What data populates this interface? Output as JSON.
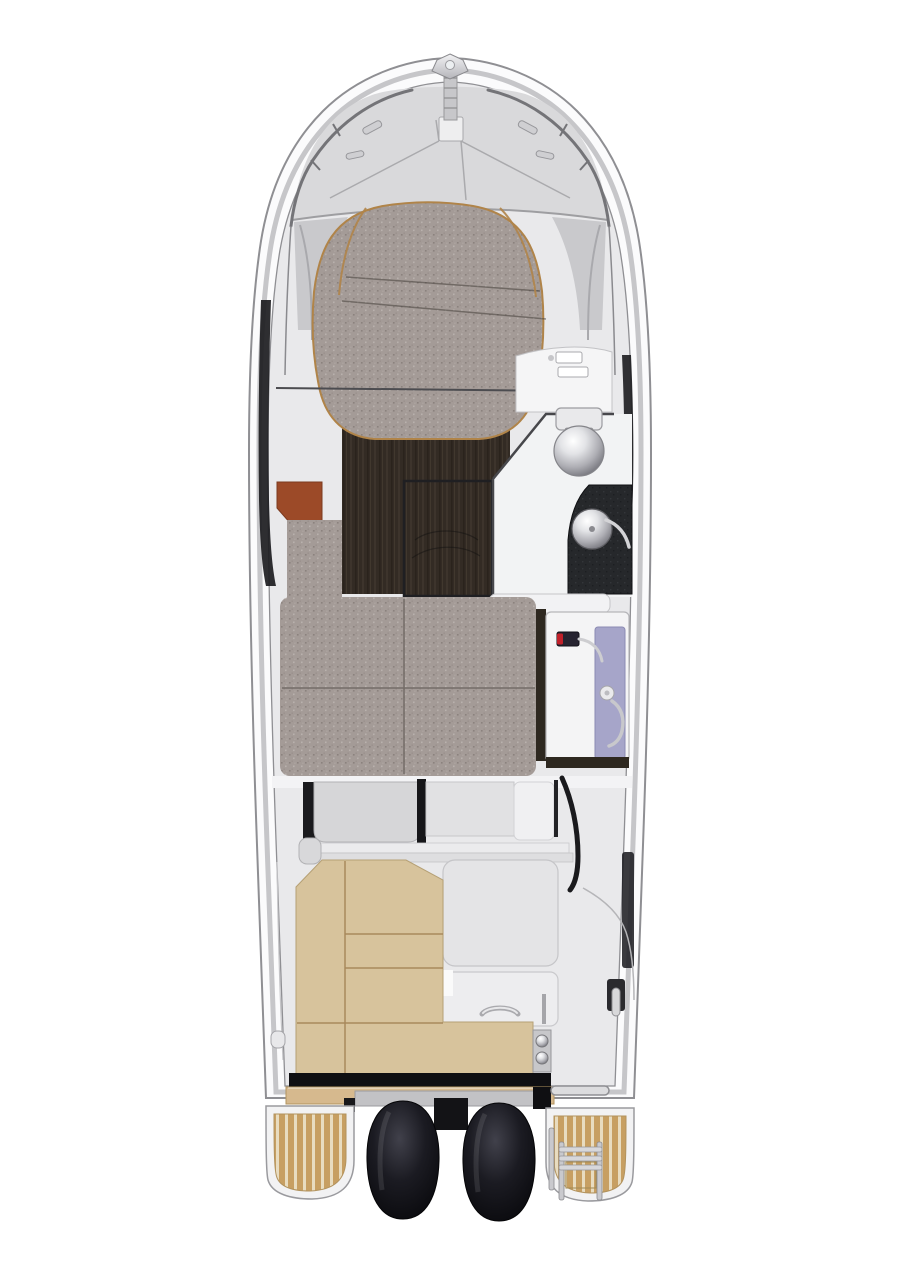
{
  "scene": {
    "type": "boat-floor-plan-top-view",
    "orientation": "bow-up",
    "engine_count": 2,
    "swim_platform_count": 2,
    "berths": [
      "v-berth-forward",
      "mid-cabin-berth"
    ],
    "features": [
      "bow-navigation-light",
      "anchor-roller",
      "windlass-hatch",
      "bow-rails",
      "deck-cleats",
      "head-with-toilet-and-sink",
      "galley-counter",
      "terracotta-seat",
      "walnut-cabin-floor",
      "cockpit-l-bench",
      "cockpit-table-modules",
      "stern-latches",
      "boarding-ladder",
      "teak-swim-platforms",
      "twin-outboard-engines",
      "grab-rail"
    ]
  },
  "colors": {
    "hull_fill": "#fbfbfc",
    "hull_stroke": "#8f8f93",
    "rim_band": "#c6c6c9",
    "deck": "#d9d9db",
    "interior": "#e9e9eb",
    "shade_gray": "#c9c9cc",
    "cushion_gray": "#a49b97",
    "cushion_dot_dark": "#8b827e",
    "cushion_dot_light": "#b9b1ad",
    "cushion_trim": "#b08449",
    "walnut": "#332b24",
    "walnut_streak_light": "#3d342c",
    "walnut_streak_dark": "#2a231c",
    "terracotta": "#9c4a28",
    "head_floor": "#f2f3f4",
    "counter_dark": "#26282b",
    "lavender": "#a6a5c9",
    "appliance_body": "#262330",
    "appliance_red": "#c1202a",
    "landing_white": "#f2f2f4",
    "frame_dark": "#1a1a1d",
    "console_gray": "#d6d6d8",
    "module_gray": "#e4e4e6",
    "bench_tan": "#d7c39c",
    "bench_seam": "#a8895c",
    "stripe_black": "#0f0f12",
    "step_tan": "#d6b98e",
    "teak_plank": "#c79f62",
    "teak_gap": "#e8dcc0",
    "engine_black": "#07070a",
    "metal_light": "#d8d8da",
    "platform_white": "#f2f2f3"
  }
}
